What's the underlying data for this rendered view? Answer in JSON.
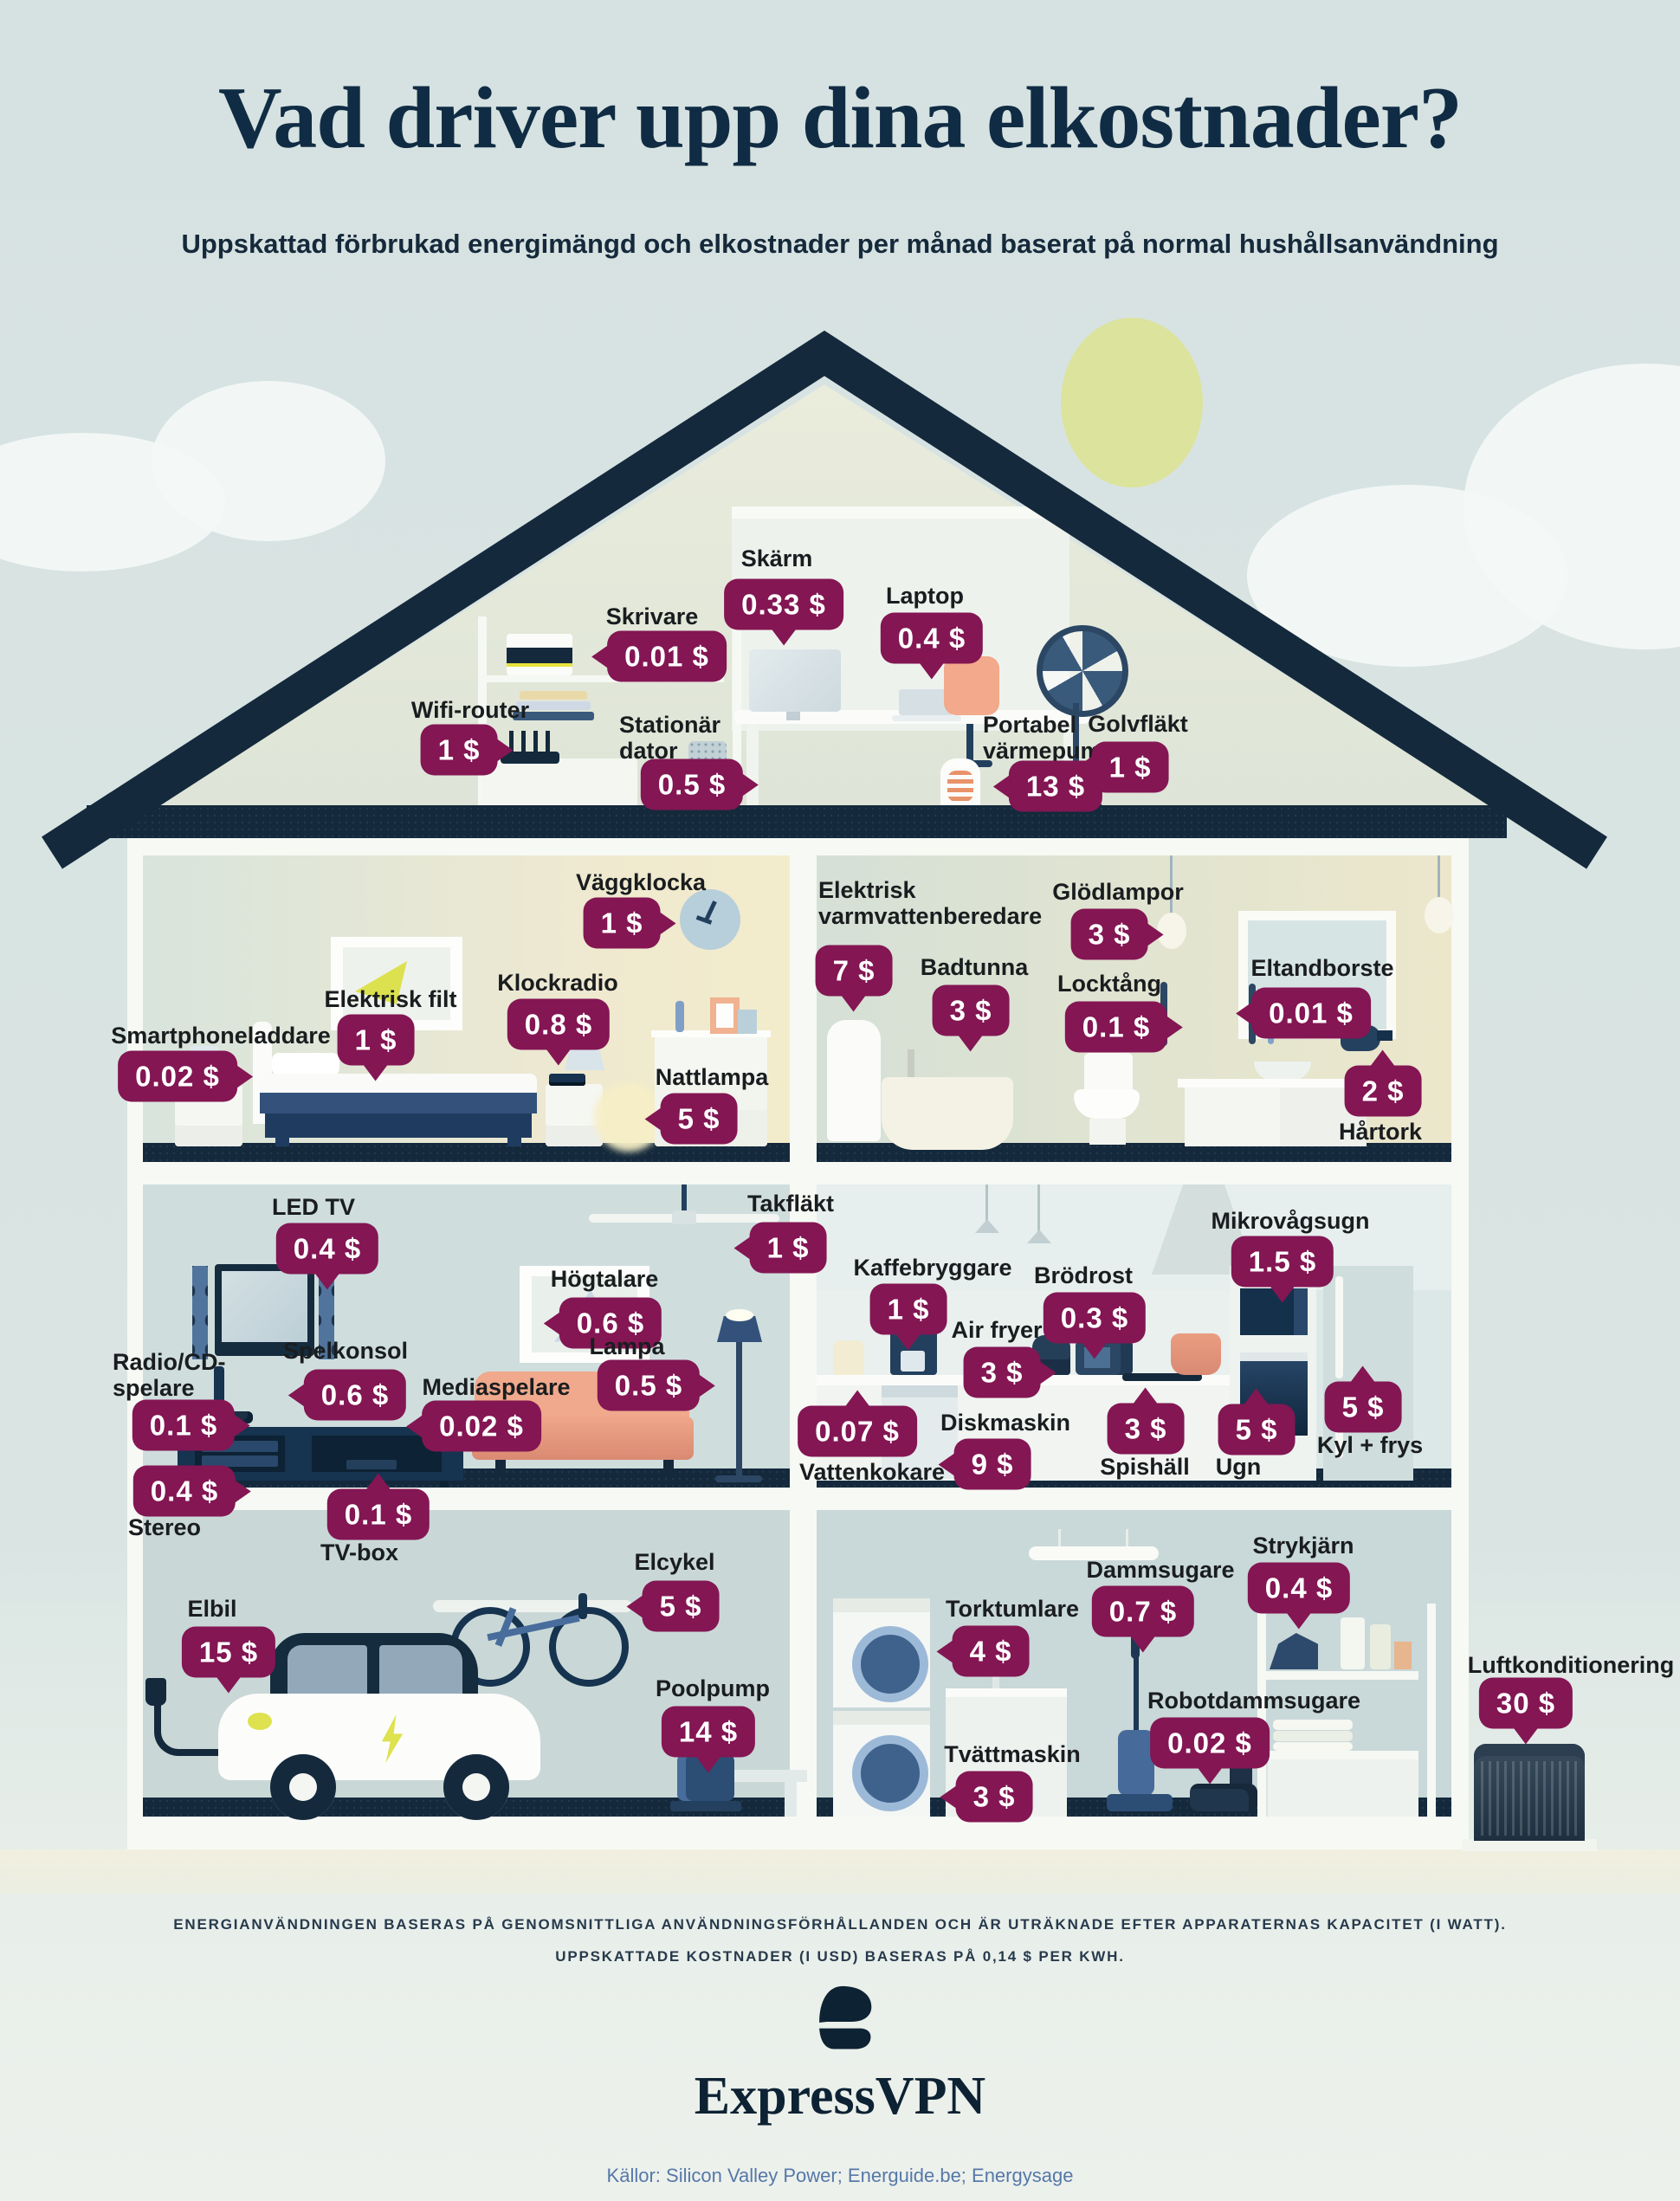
{
  "title": "Vad driver upp dina elkostnader?",
  "subtitle": "Uppskattad förbrukad energimängd och elkostnader per månad baserat på normal hushållsanvändning",
  "colors": {
    "badge": "#831653",
    "navy": "#14293c",
    "sun": "#dce39c",
    "sources_text": "#5678a8"
  },
  "appliances": [
    {
      "id": "skarm",
      "label": "Skärm",
      "cost": "0.33 $"
    },
    {
      "id": "skrivare",
      "label": "Skrivare",
      "cost": "0.01 $"
    },
    {
      "id": "laptop",
      "label": "Laptop",
      "cost": "0.4 $"
    },
    {
      "id": "wifi_router",
      "label": "Wifi-router",
      "cost": "1 $"
    },
    {
      "id": "stationar_dator",
      "label": "Stationär dator",
      "cost": "0.5 $"
    },
    {
      "id": "portabel_varmepump",
      "label": "Portabel värmepump",
      "cost": "13 $"
    },
    {
      "id": "golvflakt",
      "label": "Golvfläkt",
      "cost": "1 $"
    },
    {
      "id": "vaggklocka",
      "label": "Väggklocka",
      "cost": "1 $"
    },
    {
      "id": "elektrisk_filt",
      "label": "Elektrisk filt",
      "cost": "1 $"
    },
    {
      "id": "klockradio",
      "label": "Klockradio",
      "cost": "0.8 $"
    },
    {
      "id": "smartphoneladdare",
      "label": "Smartphoneladdare",
      "cost": "0.02 $"
    },
    {
      "id": "nattlampa",
      "label": "Nattlampa",
      "cost": "5 $"
    },
    {
      "id": "elektrisk_varmvattenberedare",
      "label": "Elektrisk varmvattenberedare",
      "cost": "7 $"
    },
    {
      "id": "badtunna",
      "label": "Badtunna",
      "cost": "3 $"
    },
    {
      "id": "glodlampor",
      "label": "Glödlampor",
      "cost": "3 $"
    },
    {
      "id": "locktang",
      "label": "Locktång",
      "cost": "0.1 $"
    },
    {
      "id": "eltandborste",
      "label": "Eltandborste",
      "cost": "0.01 $"
    },
    {
      "id": "hartork",
      "label": "Hårtork",
      "cost": "2 $"
    },
    {
      "id": "led_tv",
      "label": "LED TV",
      "cost": "0.4 $"
    },
    {
      "id": "takflakt",
      "label": "Takfläkt",
      "cost": "1 $"
    },
    {
      "id": "hogtalare",
      "label": "Högtalare",
      "cost": "0.6 $"
    },
    {
      "id": "spelkonsol",
      "label": "Spelkonsol",
      "cost": "0.6 $"
    },
    {
      "id": "radio_cd_spelare",
      "label": "Radio/CD-spelare",
      "cost": "0.1 $"
    },
    {
      "id": "mediaspelare",
      "label": "Mediaspelare",
      "cost": "0.02 $"
    },
    {
      "id": "lampa",
      "label": "Lampa",
      "cost": "0.5 $"
    },
    {
      "id": "stereo",
      "label": "Stereo",
      "cost": "0.4 $"
    },
    {
      "id": "tv_box",
      "label": "TV-box",
      "cost": "0.1 $"
    },
    {
      "id": "kaffebryggare",
      "label": "Kaffebryggare",
      "cost": "1 $"
    },
    {
      "id": "brodrost",
      "label": "Brödrost",
      "cost": "0.3 $"
    },
    {
      "id": "air_fryer",
      "label": "Air fryer",
      "cost": "3 $"
    },
    {
      "id": "mikrovagsugn",
      "label": "Mikrovågsugn",
      "cost": "1.5 $"
    },
    {
      "id": "vattenkokare",
      "label": "Vattenkokare",
      "cost": "0.07 $"
    },
    {
      "id": "diskmaskin",
      "label": "Diskmaskin",
      "cost": "9 $"
    },
    {
      "id": "spishall",
      "label": "Spishäll",
      "cost": "3 $"
    },
    {
      "id": "ugn",
      "label": "Ugn",
      "cost": "5 $"
    },
    {
      "id": "kyl_frys",
      "label": "Kyl + frys",
      "cost": "5 $"
    },
    {
      "id": "elbil",
      "label": "Elbil",
      "cost": "15 $"
    },
    {
      "id": "elcykel",
      "label": "Elcykel",
      "cost": "5 $"
    },
    {
      "id": "poolpump",
      "label": "Poolpump",
      "cost": "14 $"
    },
    {
      "id": "torktumlare",
      "label": "Torktumlare",
      "cost": "4 $"
    },
    {
      "id": "dammsugare",
      "label": "Dammsugare",
      "cost": "0.7 $"
    },
    {
      "id": "strykjarn",
      "label": "Strykjärn",
      "cost": "0.4 $"
    },
    {
      "id": "robotdammsugare",
      "label": "Robotdammsugare",
      "cost": "0.02 $"
    },
    {
      "id": "tvattmaskin",
      "label": "Tvättmaskin",
      "cost": "3 $"
    },
    {
      "id": "luftkonditionering",
      "label": "Luftkonditionering",
      "cost": "30 $"
    }
  ],
  "footer": {
    "disclaimer": "ENERGIANVÄNDNINGEN BASERAS PÅ GENOMSNITTLIGA ANVÄNDNINGSFÖRHÅLLANDEN OCH ÄR UTRÄKNADE EFTER APPARATERNAS KAPACITET (I WATT). UPPSKATTADE KOSTNADER (I USD) BASERAS PÅ 0,14 $ PER KWH.",
    "brand": "ExpressVPN",
    "sources": "Källor: Silicon Valley Power; Energuide.be; Energysage"
  }
}
